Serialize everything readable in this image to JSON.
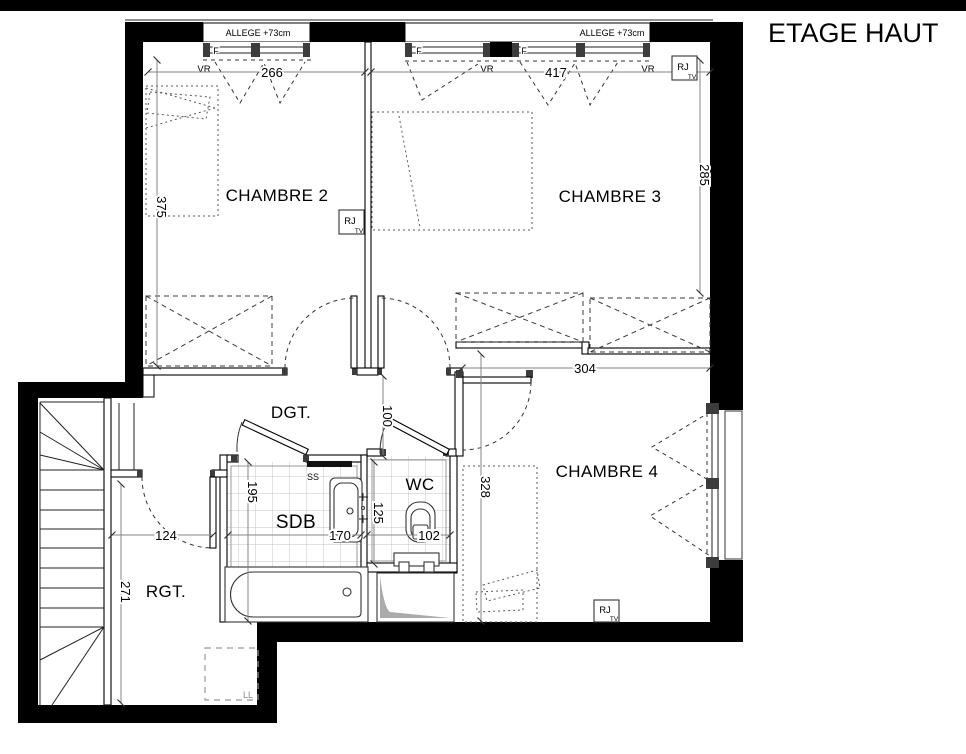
{
  "title": "ETAGE HAUT",
  "rooms": {
    "chambre2": "CHAMBRE 2",
    "chambre3": "CHAMBRE 3",
    "chambre4": "CHAMBRE 4",
    "degagement": "DGT.",
    "salle_de_bain": "SDB",
    "wc": "WC",
    "rangement": "RGT."
  },
  "window_annotations": {
    "allege": "ALLEGE +73cm",
    "fenetre": "F",
    "volet_roulant": "VR"
  },
  "tech_outlets": {
    "rj": "RJ",
    "tv": "TV"
  },
  "equipment": {
    "seche_serviettes": "SS",
    "lave_linge": "LL"
  },
  "dimensions_cm": {
    "chambre2_width": "266",
    "chambre3_width": "417",
    "chambre2_depth": "375",
    "chambre3_depth": "285",
    "chambre4_width": "304",
    "degagement_width": "100",
    "chambre4_depth": "328",
    "sdb_depth": "195",
    "sdb_width": "170",
    "wc_width": "102",
    "wc_depth": "125",
    "rangement_width": "124",
    "rangement_depth": "271"
  }
}
